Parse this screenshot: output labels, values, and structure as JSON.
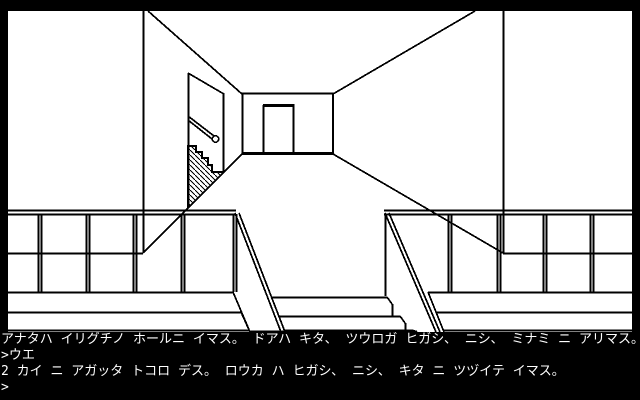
{
  "colors": {
    "background": "#000000",
    "scene_background": "#ffffff",
    "line_ink": "#000000",
    "text": "#ffffff"
  },
  "console": {
    "lines": [
      {
        "type": "narration",
        "text": "アナタハ イリグチノ ホールニ イマス。 ドアハ キタ、 ツウロガ ヒガシ、 ニシ、 ミナミ ニ アリマス。 カイダンヲ アガルト 2カイデス"
      },
      {
        "type": "player_command",
        "text": ">ウエ"
      },
      {
        "type": "narration",
        "text": "2 カイ ニ アガッタ トコロ デス。 ロウカ ハ ヒガシ、 ニシ、 キタ ニ ツヅイテ イマス。"
      },
      {
        "type": "prompt",
        "text": ">"
      }
    ]
  }
}
